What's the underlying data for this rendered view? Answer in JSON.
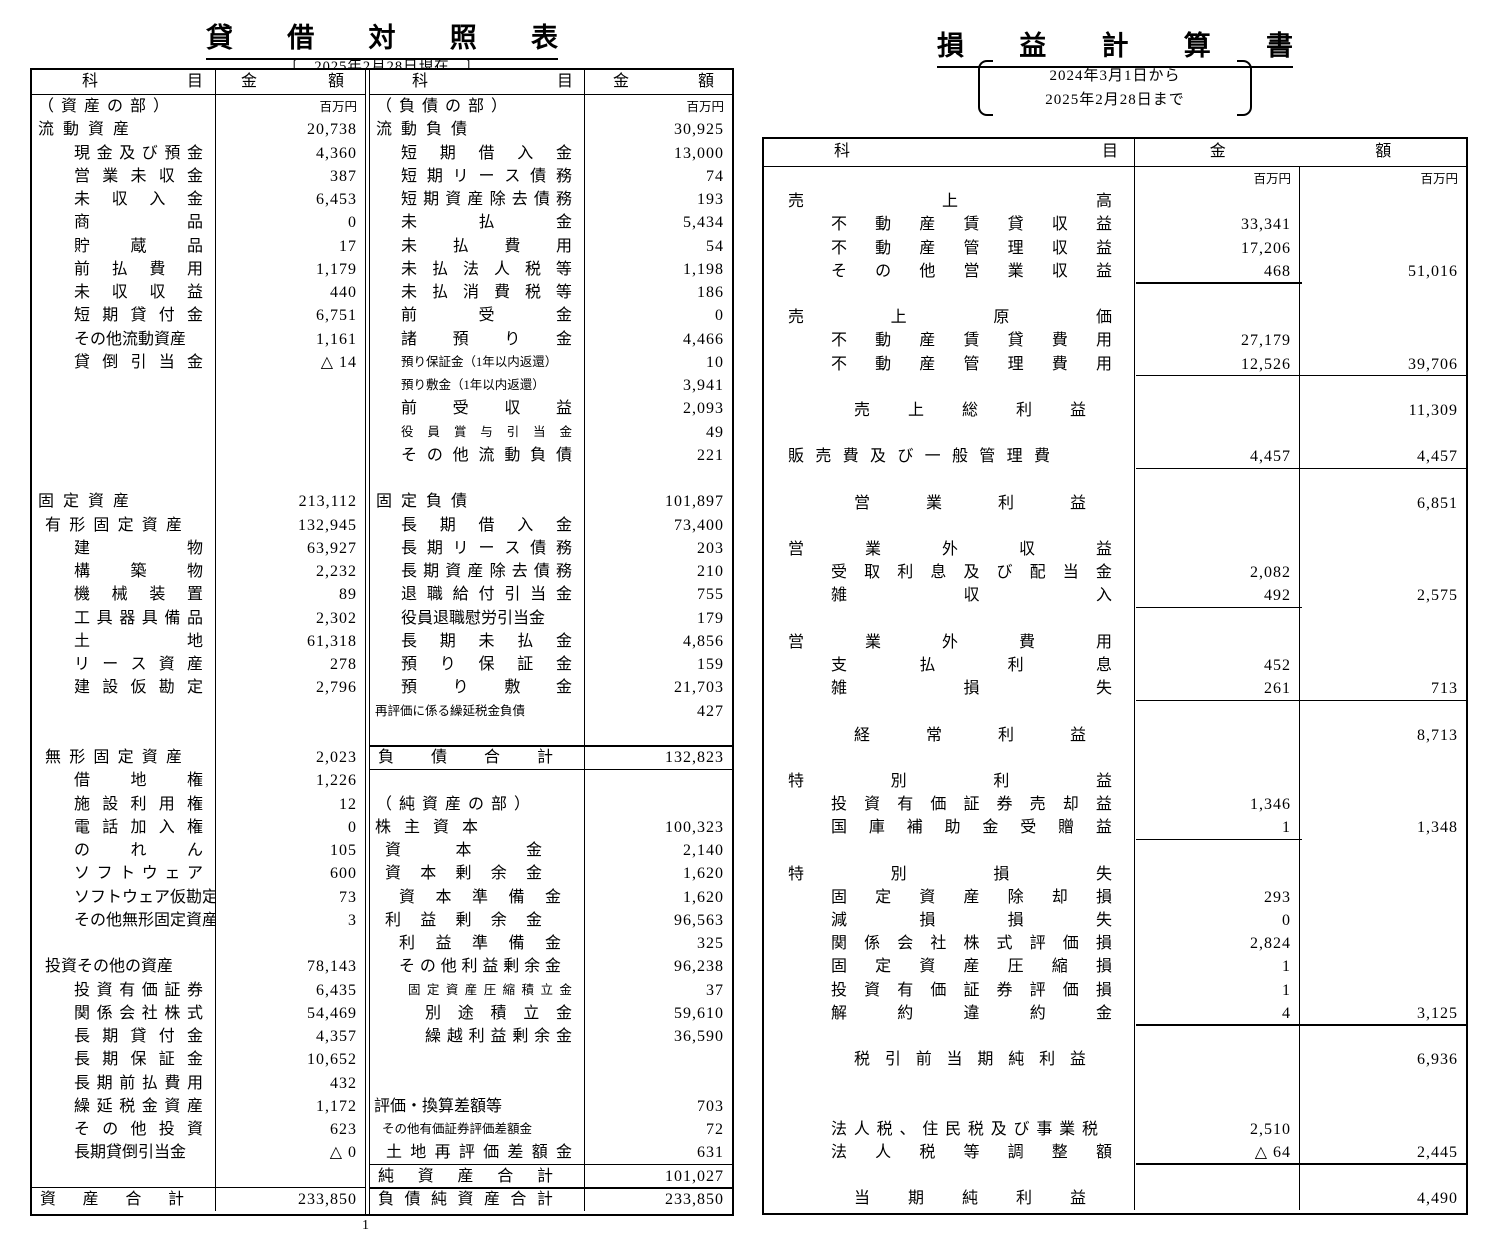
{
  "page_number": "1",
  "colors": {
    "ink": "#000000",
    "paper": "#ffffff"
  },
  "balance_sheet": {
    "title": "貸借対照表",
    "date_note": "〔　2025年2月28日現在　〕",
    "unit_label": "百万円",
    "header": {
      "account": "科目",
      "amount": "金額"
    },
    "assets_rows": [
      {
        "l": "（資産の部）",
        "s": "part",
        "u": "百万円"
      },
      {
        "l": "流動資産",
        "s": "head",
        "v": "20,738"
      },
      {
        "l": "現金及び預金",
        "s": "leaf",
        "v": "4,360"
      },
      {
        "l": "営業未収金",
        "s": "leaf",
        "v": "387"
      },
      {
        "l": "未収入金",
        "s": "leaf",
        "v": "6,453"
      },
      {
        "l": "商品",
        "s": "leaf",
        "v": "0"
      },
      {
        "l": "貯蔵品",
        "s": "leaf",
        "v": "17"
      },
      {
        "l": "前払費用",
        "s": "leaf",
        "v": "1,179"
      },
      {
        "l": "未収収益",
        "s": "leaf",
        "v": "440"
      },
      {
        "l": "短期貸付金",
        "s": "leaf",
        "v": "6,751"
      },
      {
        "l": "その他流動資産",
        "s": "lt",
        "v": "1,161"
      },
      {
        "l": "貸倒引当金",
        "s": "leaf",
        "v": "△ 14"
      },
      {},
      {},
      {},
      {},
      {},
      {
        "l": "固定資産",
        "s": "head",
        "v": "213,112"
      },
      {
        "l": "有形固定資産",
        "s": "mid",
        "v": "132,945"
      },
      {
        "l": "建物",
        "s": "leaf",
        "v": "63,927"
      },
      {
        "l": "構築物",
        "s": "leaf",
        "v": "2,232"
      },
      {
        "l": "機械装置",
        "s": "leaf",
        "v": "89"
      },
      {
        "l": "工具器具備品",
        "s": "leaf",
        "v": "2,302"
      },
      {
        "l": "土地",
        "s": "leaf",
        "v": "61,318"
      },
      {
        "l": "リース資産",
        "s": "leaf",
        "v": "278"
      },
      {
        "l": "建設仮勘定",
        "s": "leaf",
        "v": "2,796"
      },
      {},
      {},
      {
        "l": "無形固定資産",
        "s": "mid",
        "v": "2,023"
      },
      {
        "l": "借地権",
        "s": "leaf",
        "v": "1,226"
      },
      {
        "l": "施設利用権",
        "s": "leaf",
        "v": "12"
      },
      {
        "l": "電話加入権",
        "s": "leaf",
        "v": "0"
      },
      {
        "l": "のれん",
        "s": "leaf",
        "v": "105"
      },
      {
        "l": "ソフトウェア",
        "s": "leaf",
        "v": "600"
      },
      {
        "l": "ソフトウェア仮勘定",
        "s": "lt",
        "v": "73"
      },
      {
        "l": "その他無形固定資産",
        "s": "lt",
        "v": "3"
      },
      {},
      {
        "l": "投資その他の資産",
        "s": "mt",
        "v": "78,143"
      },
      {
        "l": "投資有価証券",
        "s": "leaf",
        "v": "6,435"
      },
      {
        "l": "関係会社株式",
        "s": "leaf",
        "v": "54,469"
      },
      {
        "l": "長期貸付金",
        "s": "leaf",
        "v": "4,357"
      },
      {
        "l": "長期保証金",
        "s": "leaf",
        "v": "10,652"
      },
      {
        "l": "長期前払費用",
        "s": "leaf",
        "v": "432"
      },
      {
        "l": "繰延税金資産",
        "s": "leaf",
        "v": "1,172"
      },
      {
        "l": "その他投資",
        "s": "leaf",
        "v": "623"
      },
      {
        "l": "長期貸倒引当金",
        "s": "lt",
        "v": "△ 0"
      },
      {},
      {
        "l": "資産合計",
        "s": "total",
        "v": "233,850",
        "r": "top"
      }
    ],
    "liabilities_rows": [
      {
        "l": "（負債の部）",
        "s": "part",
        "u": "百万円"
      },
      {
        "l": "流動負債",
        "s": "head",
        "v": "30,925"
      },
      {
        "l": "短期借入金",
        "s": "leaf",
        "v": "13,000"
      },
      {
        "l": "短期リース債務",
        "s": "leaf",
        "v": "74"
      },
      {
        "l": "短期資産除去債務",
        "s": "leaf",
        "v": "193"
      },
      {
        "l": "未払金",
        "s": "leaf",
        "v": "5,434"
      },
      {
        "l": "未払費用",
        "s": "leaf",
        "v": "54"
      },
      {
        "l": "未払法人税等",
        "s": "leaf",
        "v": "1,198"
      },
      {
        "l": "未払消費税等",
        "s": "leaf",
        "v": "186"
      },
      {
        "l": "前受金",
        "s": "leaf",
        "v": "0"
      },
      {
        "l": "諸預り金",
        "s": "leaf",
        "v": "4,466"
      },
      {
        "l": "預り保証金（1年以内返還）",
        "s": "st",
        "v": "10"
      },
      {
        "l": "預り敷金（1年以内返還）",
        "s": "st",
        "v": "3,941"
      },
      {
        "l": "前受収益",
        "s": "leaf",
        "v": "2,093"
      },
      {
        "l": "役員賞与引当金",
        "s": "sl",
        "v": "49"
      },
      {
        "l": "その他流動負債",
        "s": "leaf",
        "v": "221"
      },
      {},
      {
        "l": "固定負債",
        "s": "head",
        "v": "101,897"
      },
      {
        "l": "長期借入金",
        "s": "leaf",
        "v": "73,400"
      },
      {
        "l": "長期リース債務",
        "s": "leaf",
        "v": "203"
      },
      {
        "l": "長期資産除去債務",
        "s": "leaf",
        "v": "210"
      },
      {
        "l": "退職給付引当金",
        "s": "leaf",
        "v": "755"
      },
      {
        "l": "役員退職慰労引当金",
        "s": "lt",
        "v": "179"
      },
      {
        "l": "長期未払金",
        "s": "leaf",
        "v": "4,856"
      },
      {
        "l": "預り保証金",
        "s": "leaf",
        "v": "159"
      },
      {
        "l": "預り敷金",
        "s": "leaf",
        "v": "21,703"
      },
      {
        "l": "再評価に係る繰延税金負債",
        "s": "st0",
        "v": "427"
      },
      {},
      {
        "l": "負債合計",
        "s": "total",
        "v": "132,823",
        "r": "both"
      },
      {},
      {
        "l": "（純資産の部）",
        "s": "part"
      },
      {
        "l": "株主資本",
        "s": "eq1",
        "v": "100,323"
      },
      {
        "l": "資本金",
        "s": "eq2",
        "v": "2,140"
      },
      {
        "l": "資本剰余金",
        "s": "eq2",
        "v": "1,620"
      },
      {
        "l": "資本準備金",
        "s": "eq3",
        "v": "1,620"
      },
      {
        "l": "利益剰余金",
        "s": "eq2",
        "v": "96,563"
      },
      {
        "l": "利益準備金",
        "s": "eq3",
        "v": "325"
      },
      {
        "l": "その他利益剰余金",
        "s": "eq3",
        "v": "96,238"
      },
      {
        "l": "固定資産圧縮積立金",
        "s": "e4s",
        "v": "37"
      },
      {
        "l": "別途積立金",
        "s": "eq4",
        "v": "59,610"
      },
      {
        "l": "繰越利益剰余金",
        "s": "eq4",
        "v": "36,590"
      },
      {},
      {},
      {
        "l": "評価・換算差額等",
        "s": "ht",
        "v": "703"
      },
      {
        "l": "その他有価証券評価差額金",
        "s": "st1",
        "v": "72"
      },
      {
        "l": "土地再評価差額金",
        "s": "e2b",
        "v": "631"
      },
      {
        "l": "純資産合計",
        "s": "total",
        "v": "101,027",
        "r": "both"
      },
      {
        "l": "負債純資産合計",
        "s": "total",
        "v": "233,850"
      }
    ]
  },
  "profit_loss": {
    "title": "損益計算書",
    "period": {
      "line1": "2024年3月1日から",
      "line2": "2025年2月28日まで"
    },
    "unit_label": "百万円",
    "header": {
      "account": "科目",
      "amount_left": "金",
      "amount_right": "額"
    },
    "rows": [
      {
        "s": "unit",
        "a": "百万円",
        "b": "百万円"
      },
      {
        "l": "売上高",
        "s": "phead"
      },
      {
        "l": "不動産賃貸収益",
        "s": "pleaf",
        "a": "33,341"
      },
      {
        "l": "不動産管理収益",
        "s": "pleaf",
        "a": "17,206"
      },
      {
        "l": "その他営業収益",
        "s": "pleaf",
        "a": "468",
        "b": "51,016",
        "r": "c1"
      },
      {},
      {
        "l": "売上原価",
        "s": "phead"
      },
      {
        "l": "不動産賃貸費用",
        "s": "pleaf",
        "a": "27,179"
      },
      {
        "l": "不動産管理費用",
        "s": "pleaf",
        "a": "12,526",
        "b": "39,706",
        "r": "both"
      },
      {},
      {
        "l": "売上総利益",
        "s": "psub",
        "b": "11,309"
      },
      {},
      {
        "l": "販売費及び一般管理費",
        "s": "ph2",
        "a": "4,457",
        "b": "4,457",
        "r": "both"
      },
      {},
      {
        "l": "営業利益",
        "s": "psub",
        "b": "6,851"
      },
      {},
      {
        "l": "営業外収益",
        "s": "phead"
      },
      {
        "l": "受取利息及び配当金",
        "s": "pleaf",
        "a": "2,082"
      },
      {
        "l": "雑収入",
        "s": "pleaf",
        "a": "492",
        "b": "2,575",
        "r": "c1"
      },
      {},
      {
        "l": "営業外費用",
        "s": "phead"
      },
      {
        "l": "支払利息",
        "s": "pleaf",
        "a": "452"
      },
      {
        "l": "雑損失",
        "s": "pleaf",
        "a": "261",
        "b": "713",
        "r": "both"
      },
      {},
      {
        "l": "経常利益",
        "s": "psub",
        "b": "8,713"
      },
      {},
      {
        "l": "特別利益",
        "s": "phead"
      },
      {
        "l": "投資有価証券売却益",
        "s": "pleaf",
        "a": "1,346"
      },
      {
        "l": "国庫補助金受贈益",
        "s": "pleaf",
        "a": "1",
        "b": "1,348",
        "r": "c1"
      },
      {},
      {
        "l": "特別損失",
        "s": "phead"
      },
      {
        "l": "固定資産除却損",
        "s": "pleaf",
        "a": "293"
      },
      {
        "l": "減損損失",
        "s": "pleaf",
        "a": "0"
      },
      {
        "l": "関係会社株式評価損",
        "s": "pleaf",
        "a": "2,824"
      },
      {
        "l": "固定資産圧縮損",
        "s": "pleaf",
        "a": "1"
      },
      {
        "l": "投資有価証券評価損",
        "s": "pleaf",
        "a": "1"
      },
      {
        "l": "解約違約金",
        "s": "pleaf",
        "a": "4",
        "b": "3,125",
        "r": "both"
      },
      {},
      {
        "l": "税引前当期純利益",
        "s": "psub",
        "b": "6,936"
      },
      {},
      {},
      {
        "l": "法人税、住民税及び事業税",
        "s": "plt",
        "a": "2,510"
      },
      {
        "l": "法人税等調整額",
        "s": "pleaf",
        "a": "△ 64",
        "b": "2,445",
        "r": "both"
      },
      {},
      {
        "l": "当期純利益",
        "s": "psub",
        "b": "4,490"
      }
    ]
  }
}
